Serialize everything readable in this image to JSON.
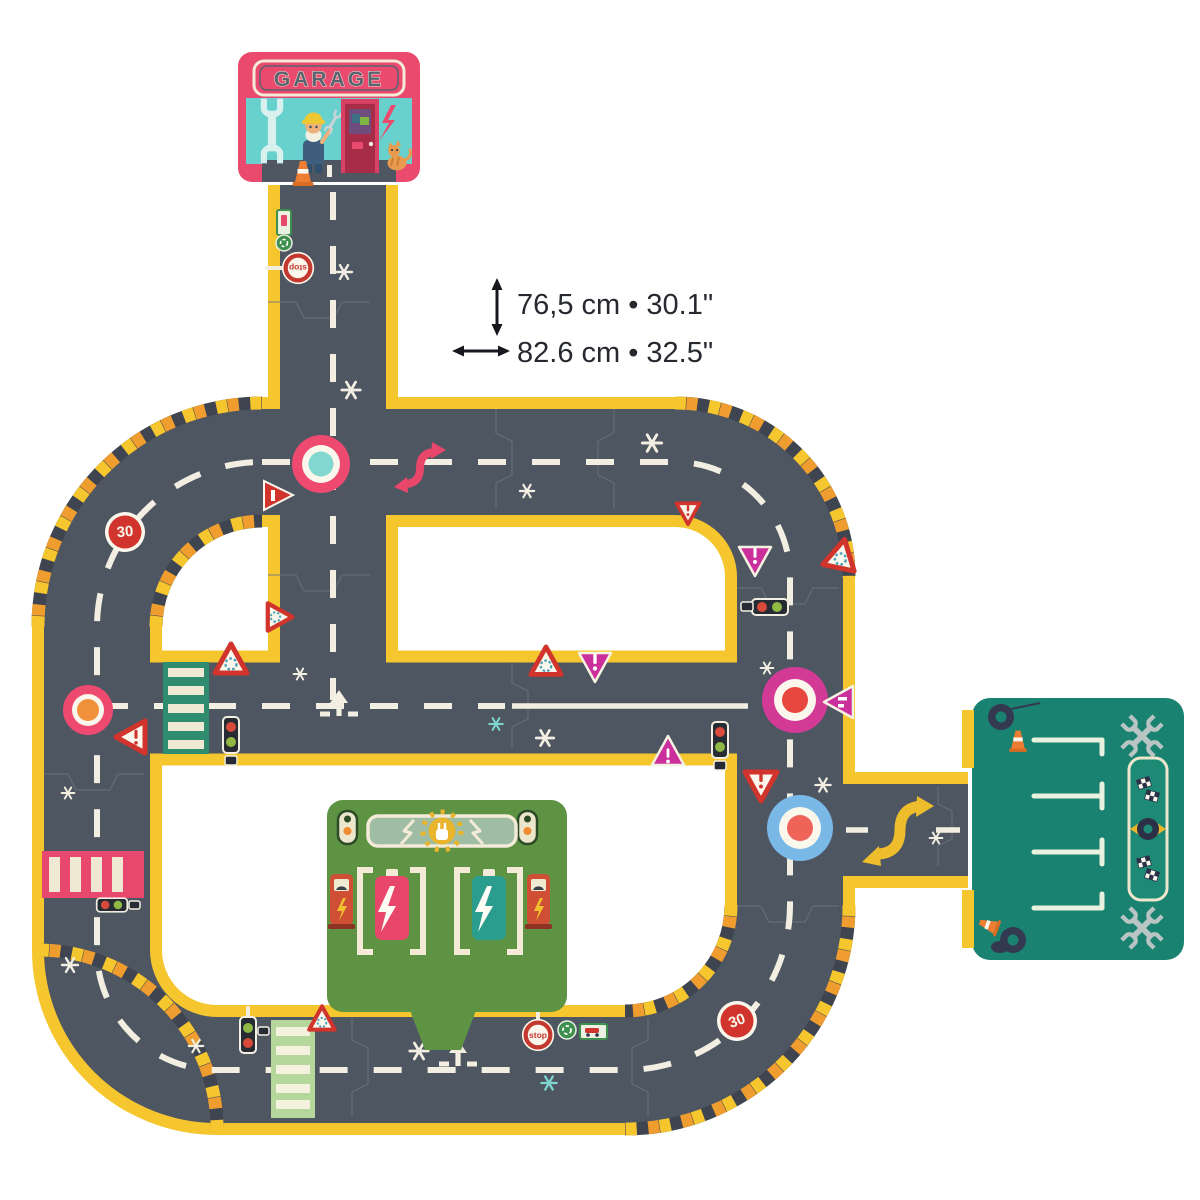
{
  "annotations": {
    "height_label": "76,5 cm • 30.1\"",
    "width_label": "82.6 cm • 32.5\""
  },
  "garage": {
    "sign_text": "GARAGE"
  },
  "signs": {
    "stop_label": "stop",
    "speed_limit_label": "30"
  },
  "colors": {
    "background": "#ffffff",
    "road": "#4e5662",
    "road_edge_yellow": "#f6c62e",
    "hazard_orange": "#ef9d2f",
    "lane_marking_cream": "#f2efe2",
    "garage_pink": "#e94a6e",
    "garage_teal": "#68d1cd",
    "charging_station_green": "#5d9343",
    "parking_teal": "#1a8270",
    "magenta_sign": "#cb2f9b",
    "red_sign": "#d0342c",
    "battery_pink": "#e8476b",
    "battery_teal": "#2a9d8f",
    "gold": "#e8b52c",
    "crosswalk_green": "#2f8c6e",
    "crosswalk_light_green": "#b5d79b",
    "crosswalk_pink": "#e8486d"
  },
  "icons": [
    "wrench-icon",
    "mechanic-icon",
    "door-icon",
    "lightning-icon",
    "cat-icon",
    "traffic-cone-icon",
    "stop-sign-icon",
    "speed-30-sign-icon",
    "yield-roundabout-sign-icon",
    "warning-sign-icon",
    "one-way-sign-icon",
    "traffic-light-icon",
    "roundabout-marking-icon",
    "crosswalk-icon",
    "straight-arrow-icon",
    "curve-arrow-icon",
    "snowflake-icon",
    "charging-plug-icon",
    "battery-icon",
    "charging-pump-icon",
    "charging-post-icon",
    "parking-lines-icon",
    "crossed-wrenches-icon",
    "tire-icon",
    "checkered-flags-icon",
    "fuel-sign-icon",
    "car-sign-icon"
  ]
}
